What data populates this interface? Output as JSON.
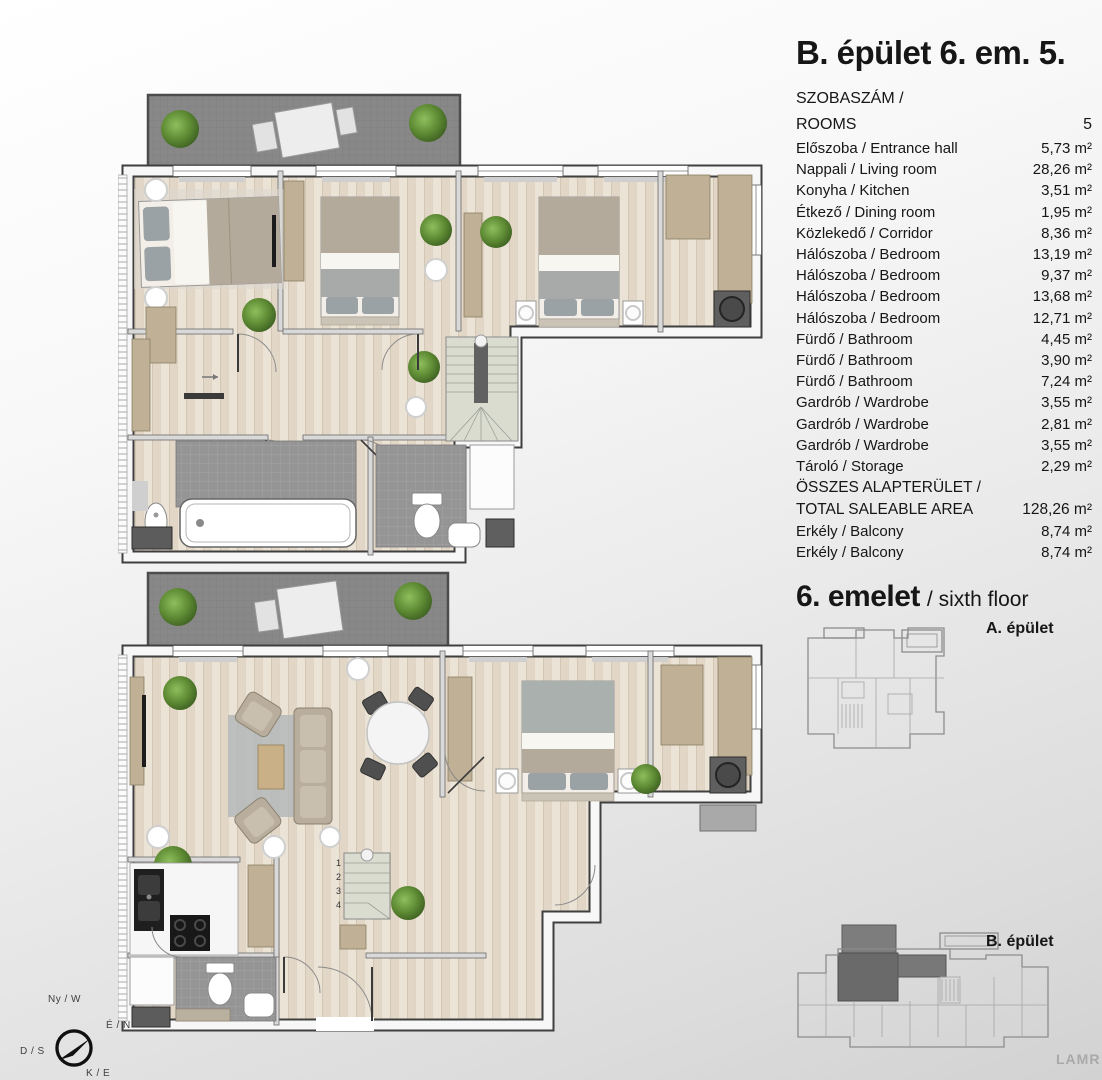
{
  "panel": {
    "title": "B. épület 6. em. 5.",
    "rooms_header": {
      "label_hu": "SZOBASZÁM /",
      "label_en": "ROOMS",
      "value": "5"
    },
    "rows": [
      {
        "label": "Előszoba / Entrance hall",
        "value": "5,73 m²"
      },
      {
        "label": "Nappali / Living room",
        "value": "28,26 m²"
      },
      {
        "label": "Konyha / Kitchen",
        "value": "3,51 m²"
      },
      {
        "label": "Étkező / Dining room",
        "value": "1,95 m²"
      },
      {
        "label": "Közlekedő / Corridor",
        "value": "8,36 m²"
      },
      {
        "label": "Hálószoba / Bedroom",
        "value": "13,19 m²"
      },
      {
        "label": "Hálószoba / Bedroom",
        "value": "9,37 m²"
      },
      {
        "label": "Hálószoba / Bedroom",
        "value": "13,68 m²"
      },
      {
        "label": "Hálószoba / Bedroom",
        "value": "12,71 m²"
      },
      {
        "label": "Fürdő / Bathroom",
        "value": "4,45 m²"
      },
      {
        "label": "Fürdő / Bathroom",
        "value": "3,90 m²"
      },
      {
        "label": "Fürdő / Bathroom",
        "value": "7,24 m²"
      },
      {
        "label": "Gardrób / Wardrobe",
        "value": "3,55 m²"
      },
      {
        "label": "Gardrób / Wardrobe",
        "value": "2,81 m²"
      },
      {
        "label": "Gardrób / Wardrobe",
        "value": "3,55 m²"
      },
      {
        "label": "Tároló / Storage",
        "value": "2,29 m²"
      }
    ],
    "total": {
      "label_hu": "ÖSSZES ALAPTERÜLET /",
      "label_en": "TOTAL SALEABLE AREA",
      "value": "128,26 m²"
    },
    "balcony_rows": [
      {
        "label": "Erkély / Balcony",
        "value": "8,74 m²"
      },
      {
        "label": "Erkély / Balcony",
        "value": "8,74 m²"
      }
    ]
  },
  "floor_heading": {
    "title": "6. emelet",
    "subtitle": "/ sixth floor"
  },
  "overview": {
    "building_a": "A. épület",
    "building_b": "B. épület"
  },
  "compass": {
    "west": "Ny / W",
    "north": "É / N",
    "south": "D / S",
    "east": "K / E"
  },
  "plan_annotations": {
    "stair_numbers": [
      "1",
      "2",
      "3",
      "4"
    ]
  },
  "watermark": "LAMR",
  "colors": {
    "balcony_deck": "#8a8a8a",
    "wood_floor": "#ebe3d6",
    "bathroom_tile": "#959595",
    "wardrobe_wood": "#bfb096",
    "stair_tread": "#dadcd0",
    "plant_green": "#5d8a33",
    "highlighted_unit": "#6a6a6a",
    "wall_outline": "#3f3f3f"
  }
}
